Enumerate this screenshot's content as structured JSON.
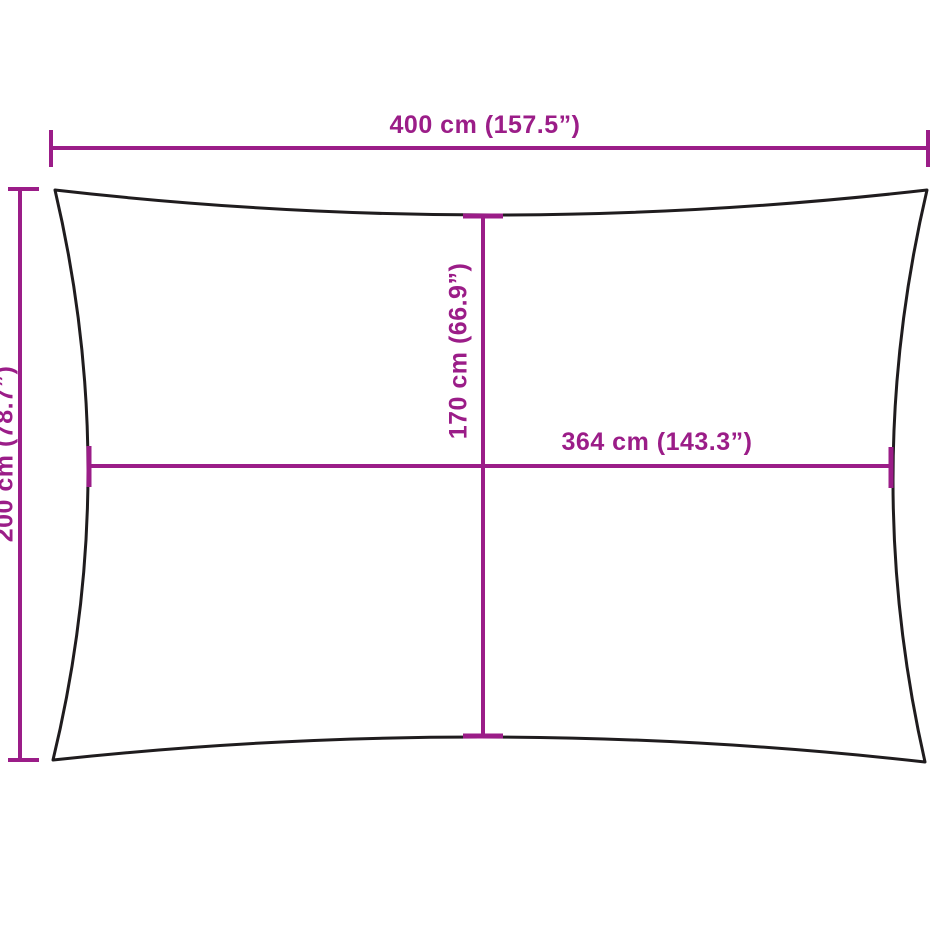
{
  "colors": {
    "dimension": "#9b1d88",
    "outline": "#1f1c1e",
    "background": "#ffffff"
  },
  "diagram": {
    "kind": "product-dimension-diagram",
    "subject": "rectangular shade sail with concave edges",
    "dimensions": {
      "top_width": {
        "label": "400 cm (157.5”)",
        "value_cm": 400,
        "value_in": 157.5
      },
      "left_height": {
        "label": "200 cm (78.7”)",
        "value_cm": 200,
        "value_in": 78.7
      },
      "center_height": {
        "label": "170 cm (66.9”)",
        "value_cm": 170,
        "value_in": 66.9
      },
      "center_width": {
        "label": "364 cm (143.3”)",
        "value_cm": 364,
        "value_in": 143.3
      }
    }
  }
}
